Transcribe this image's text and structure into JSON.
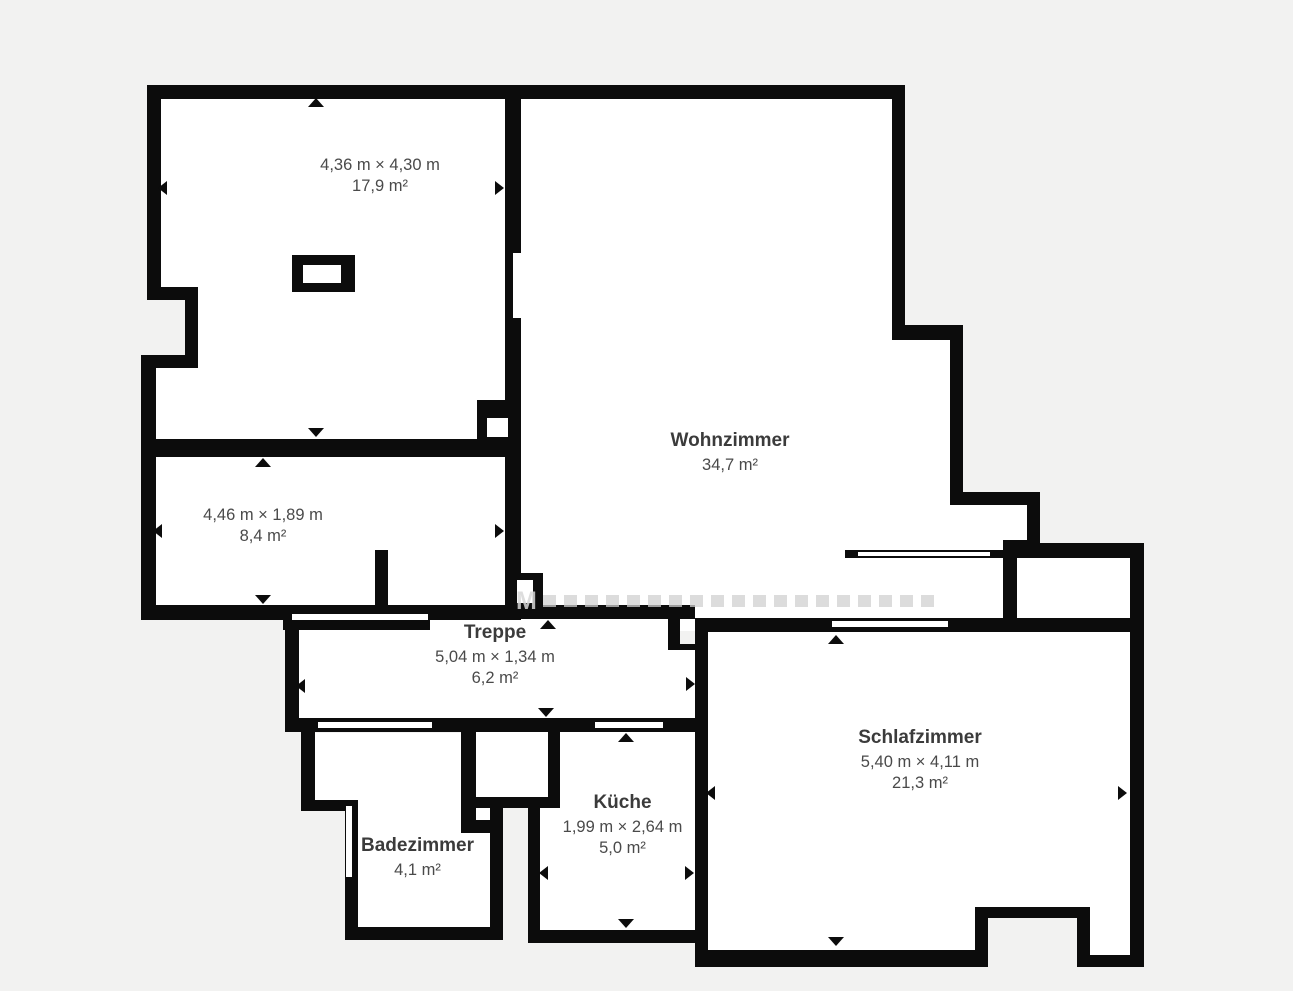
{
  "floorplan": {
    "colors": {
      "background": "#f2f2f1",
      "wall": "#0c0c0c",
      "room_fill": "#ffffff",
      "label_text": "#4a4a4a",
      "room_name_text": "#3b3b3b",
      "watermark": "#d7d7d7"
    },
    "watermark_visible_letter": "M",
    "rooms": [
      {
        "name": "",
        "dimensions": "4,36 m × 4,30 m",
        "area": "17,9 m²"
      },
      {
        "name": "Wohnzimmer",
        "dimensions": "",
        "area": "34,7 m²"
      },
      {
        "name": "",
        "dimensions": "4,46 m × 1,89 m",
        "area": "8,4 m²"
      },
      {
        "name": "Treppe",
        "dimensions": "5,04 m × 1,34 m",
        "area": "6,2 m²"
      },
      {
        "name": "Schlafzimmer",
        "dimensions": "5,40 m × 4,11 m",
        "area": "21,3 m²"
      },
      {
        "name": "Küche",
        "dimensions": "1,99 m × 2,64 m",
        "area": "5,0 m²"
      },
      {
        "name": "Badezimmer",
        "dimensions": "",
        "area": "4,1 m²"
      }
    ]
  }
}
